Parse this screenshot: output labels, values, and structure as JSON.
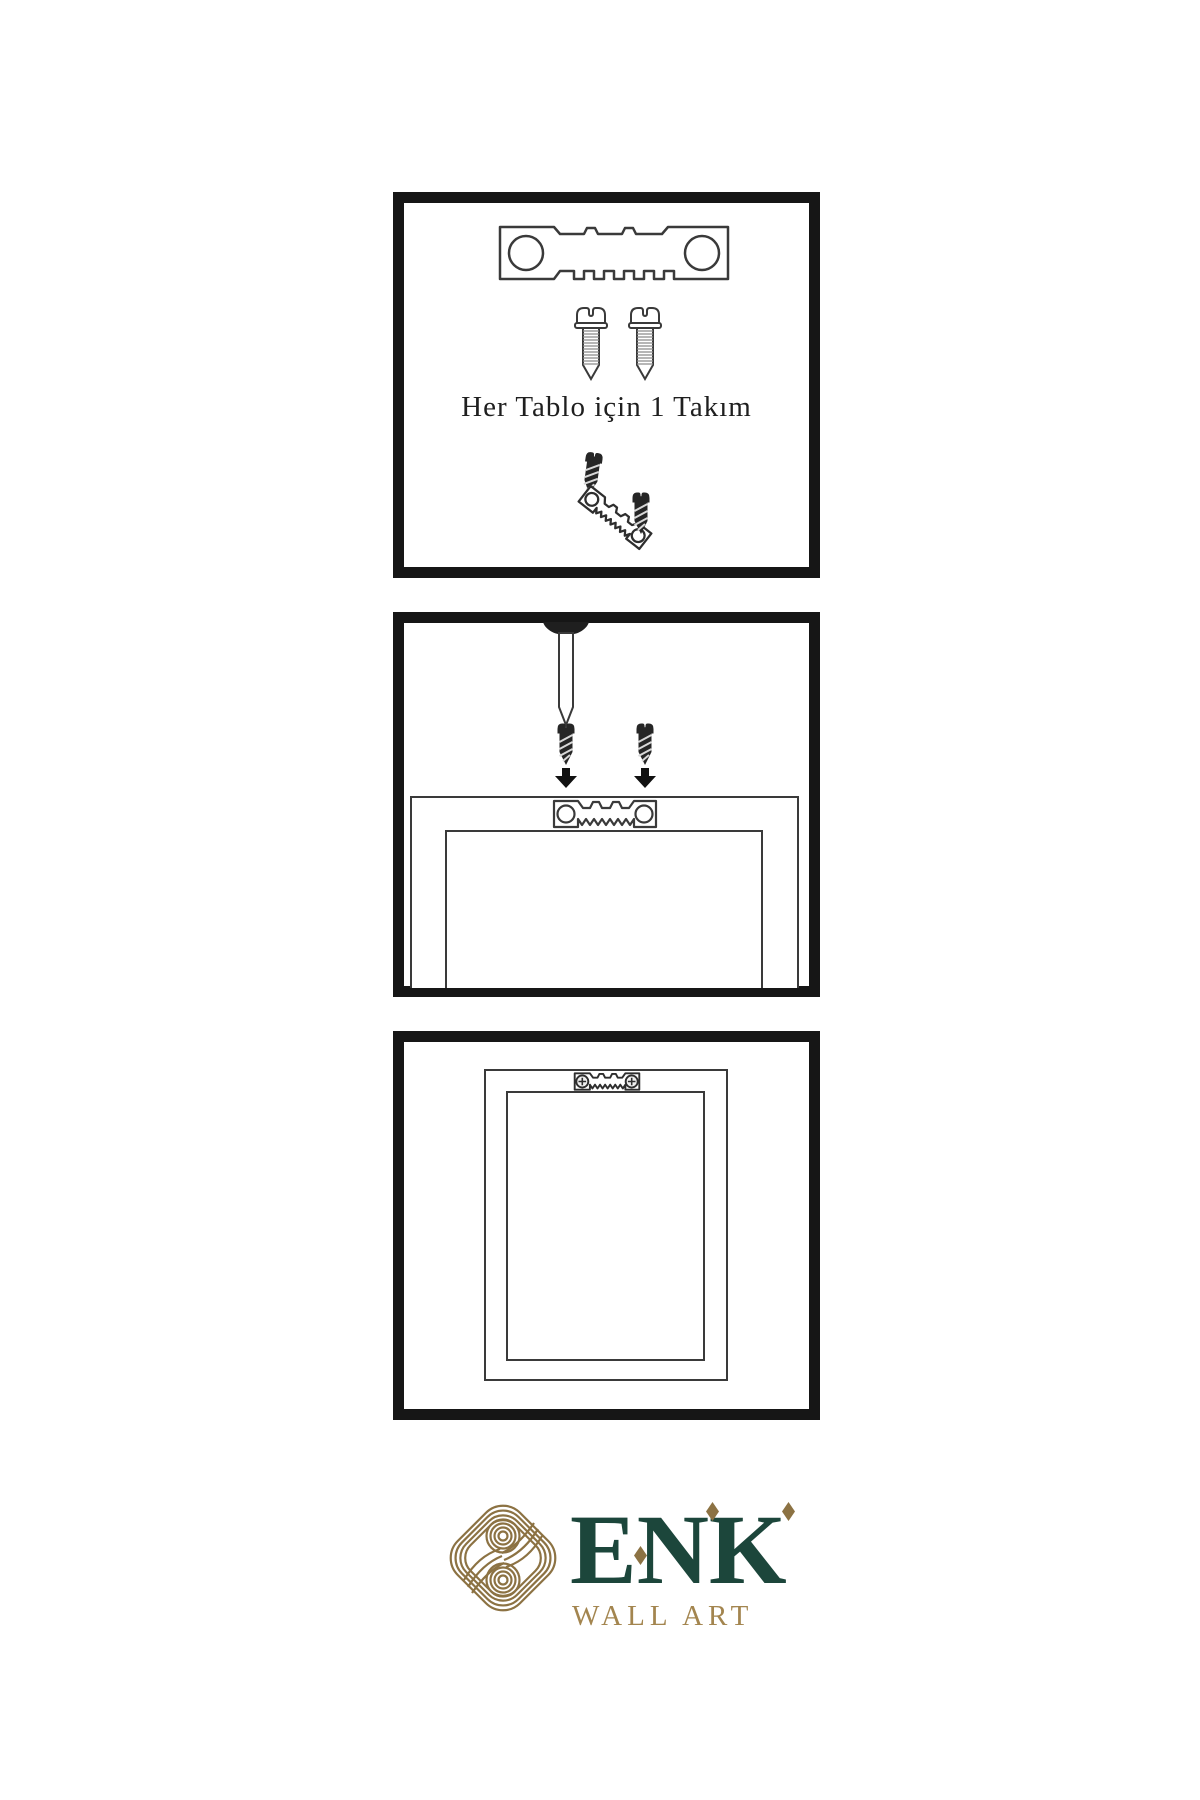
{
  "colors": {
    "background": "#ffffff",
    "panel_border": "#161616",
    "line_art": "#3a3a3a",
    "dark_hardware": "#262626",
    "brand_green": "#1c463b",
    "brand_gold": "#8c7243",
    "brand_gold_text": "#a3854f"
  },
  "steps": [
    {
      "name": "hardware-kit",
      "caption": "Her Tablo için 1 Takım",
      "items": [
        "sawtooth-hanger",
        "screw",
        "screw",
        "dark-screw",
        "tilted-sawtooth-hanger",
        "dark-screw"
      ]
    },
    {
      "name": "attach-hanger-to-frame-back",
      "items": [
        "wall-nail",
        "dark-screw",
        "dark-screw",
        "arrow-down",
        "arrow-down",
        "frame-back-outline",
        "sawtooth-hanger"
      ]
    },
    {
      "name": "hang-frame-on-nail",
      "items": [
        "frame-back-outline",
        "mounted-sawtooth-hanger"
      ]
    }
  ],
  "brand": {
    "name": "ENK",
    "tagline": "WALL ART"
  }
}
